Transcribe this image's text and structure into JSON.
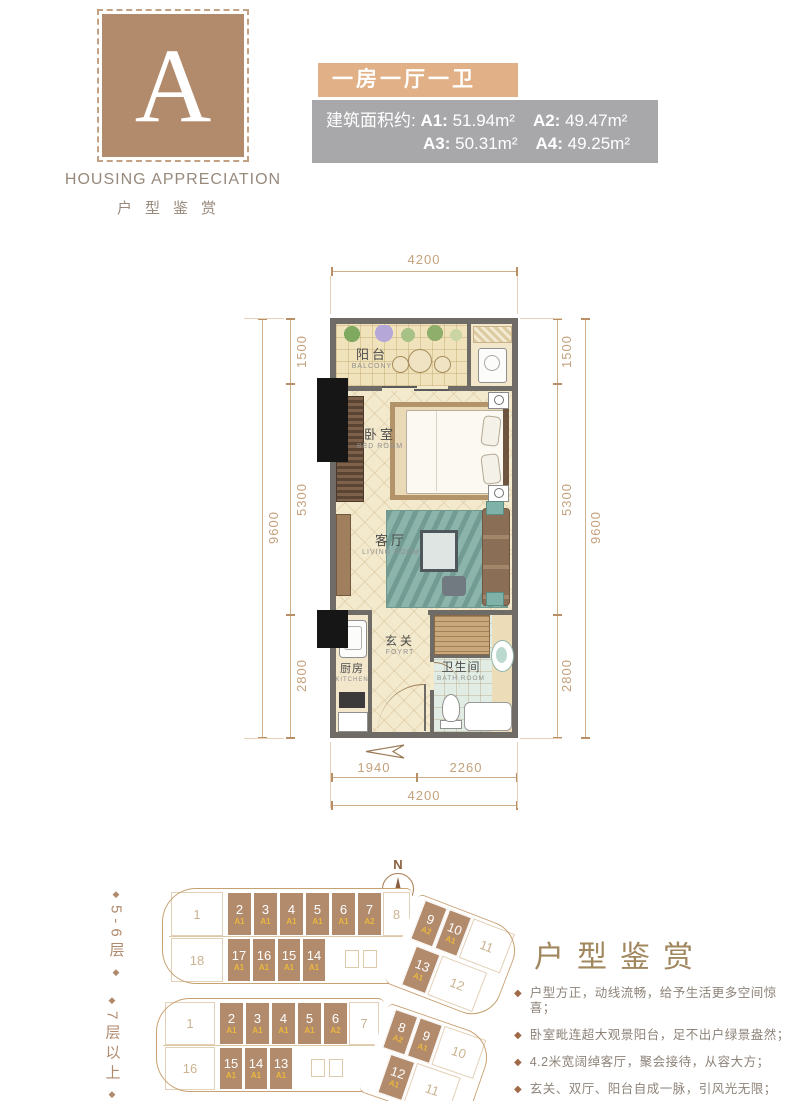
{
  "logo": {
    "letter": "A",
    "name": "HOUSING APPRECIATION",
    "name_cn": "户型鉴赏"
  },
  "header": {
    "title": "一房一厅一卫",
    "area_prefix": "建筑面积约: ",
    "units": [
      {
        "label": "A1",
        "area": "51.94m²"
      },
      {
        "label": "A2",
        "area": "49.47m²"
      },
      {
        "label": "A3",
        "area": "50.31m²"
      },
      {
        "label": "A4",
        "area": "49.25m²"
      }
    ]
  },
  "floorplan": {
    "rooms": {
      "balcony": {
        "cn": "阳台",
        "en": "BALCONY"
      },
      "bedroom": {
        "cn": "卧室",
        "en": "BED ROOM"
      },
      "living": {
        "cn": "客厅",
        "en": "LIVING ROOM"
      },
      "foyer": {
        "cn": "玄关",
        "en": "FOYRT"
      },
      "kitchen": {
        "cn": "厨房",
        "en": "KITCHEN"
      },
      "bath": {
        "cn": "卫生间",
        "en": "BATH ROOM"
      }
    },
    "dims": {
      "top": "4200",
      "left": [
        "1500",
        "5300",
        "2800"
      ],
      "left_total": "9600",
      "right": [
        "1500",
        "5300",
        "2800"
      ],
      "right_total": "9600",
      "bottom_segments": [
        "1940",
        "2260"
      ],
      "bottom_total": "4200"
    }
  },
  "compass": {
    "label": "N"
  },
  "site_plans": [
    {
      "floor_label": "5-6层",
      "top_straight": [
        {
          "no": "1"
        },
        {
          "no": "2",
          "type": "A1"
        },
        {
          "no": "3",
          "type": "A1"
        },
        {
          "no": "4",
          "type": "A1"
        },
        {
          "no": "5",
          "type": "A1"
        },
        {
          "no": "6",
          "type": "A1"
        },
        {
          "no": "7",
          "type": "A2"
        },
        {
          "no": "8"
        }
      ],
      "top_angled": [
        {
          "no": "9",
          "type": "A2"
        },
        {
          "no": "10",
          "type": "A1"
        },
        {
          "no": "11"
        }
      ],
      "bottom_straight": [
        {
          "no": "18"
        },
        {
          "no": "17",
          "type": "A1"
        },
        {
          "no": "16",
          "type": "A1"
        },
        {
          "no": "15",
          "type": "A1"
        },
        {
          "no": "14",
          "type": "A1"
        }
      ],
      "bottom_angled": [
        {
          "no": "13",
          "type": "A1"
        },
        {
          "no": "12"
        }
      ]
    },
    {
      "floor_label": "7层以上",
      "top_straight": [
        {
          "no": "1"
        },
        {
          "no": "2",
          "type": "A1"
        },
        {
          "no": "3",
          "type": "A1"
        },
        {
          "no": "4",
          "type": "A1"
        },
        {
          "no": "5",
          "type": "A1"
        },
        {
          "no": "6",
          "type": "A2"
        },
        {
          "no": "7"
        }
      ],
      "top_angled": [
        {
          "no": "8",
          "type": "A2"
        },
        {
          "no": "9",
          "type": "A1"
        },
        {
          "no": "10"
        }
      ],
      "bottom_straight": [
        {
          "no": "16"
        },
        {
          "no": "15",
          "type": "A1"
        },
        {
          "no": "14",
          "type": "A1"
        },
        {
          "no": "13",
          "type": "A1"
        }
      ],
      "bottom_angled": [
        {
          "no": "12",
          "type": "A1"
        },
        {
          "no": "11"
        }
      ]
    }
  ],
  "description": {
    "title": "户型鉴赏",
    "bullets": [
      "户型方正，动线流畅，给予生活更多空间惊喜；",
      "卧室毗连超大观景阳台，足不出户绿景盎然；",
      "4.2米宽阔绰客厅，聚会接待，从容大方；",
      "玄关、双厅、阳台自成一脉，引风光无限；",
      "开放式厨房，独具情调，缤纷美食触手可及。"
    ]
  },
  "icons": {
    "diamond": "◆",
    "north": "N"
  },
  "colors": {
    "brand_brown": "#b28b6d",
    "accent_tan": "#e1b086",
    "panel_gray": "#a8a8ab",
    "dim_text": "#c4a17c",
    "unit_type_gold": "#e9b73d",
    "wall_gray": "#6f6b66"
  }
}
